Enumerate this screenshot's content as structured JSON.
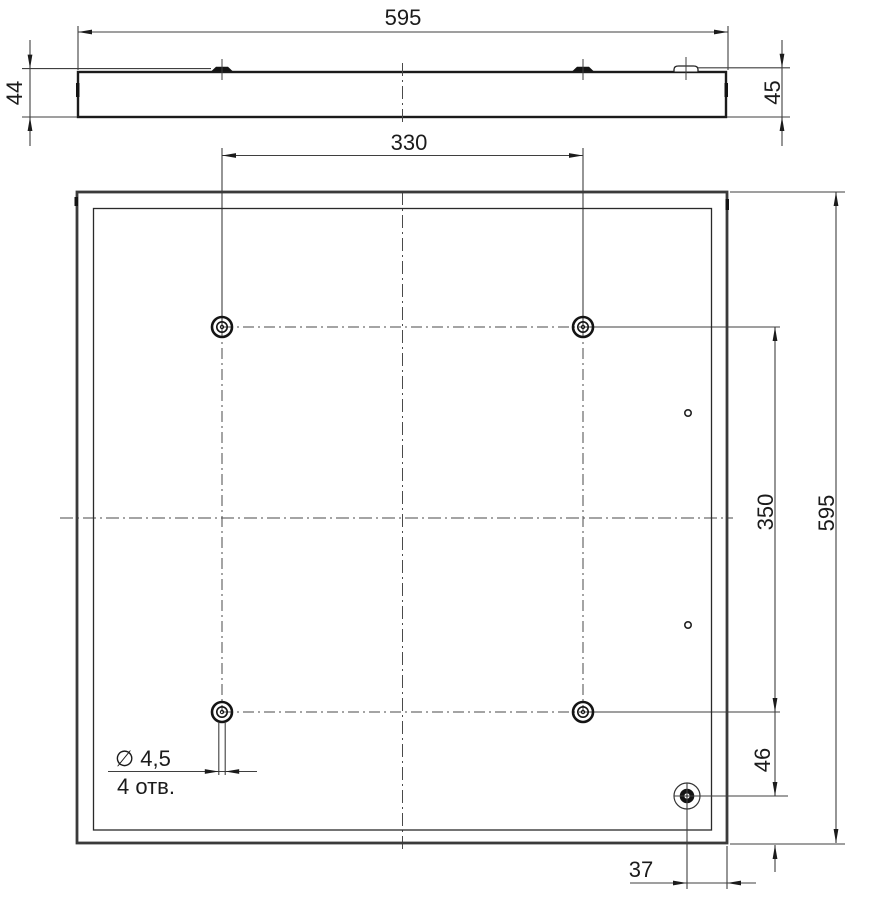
{
  "drawing": {
    "type": "technical-drawing",
    "views": {
      "side_view": "panel side profile with mounting clips",
      "rear_view": "panel rear face with mounting holes"
    }
  },
  "dims": {
    "width_top": "595",
    "height_left": "44",
    "height_right": "45",
    "hole_pitch_x": "330",
    "hole_pitch_y": "350",
    "height_overall": "595",
    "corner_hole_from_bottom": "46",
    "corner_hole_from_right": "37"
  },
  "callout": {
    "diameter": "∅ 4,5",
    "count": "4 отв."
  },
  "colors": {
    "background": "#ffffff",
    "outline": "#1b1b1b",
    "frame": "#3a3a3a",
    "thin_line": "#3f3f3f",
    "centerline": "#4a4a4a"
  }
}
